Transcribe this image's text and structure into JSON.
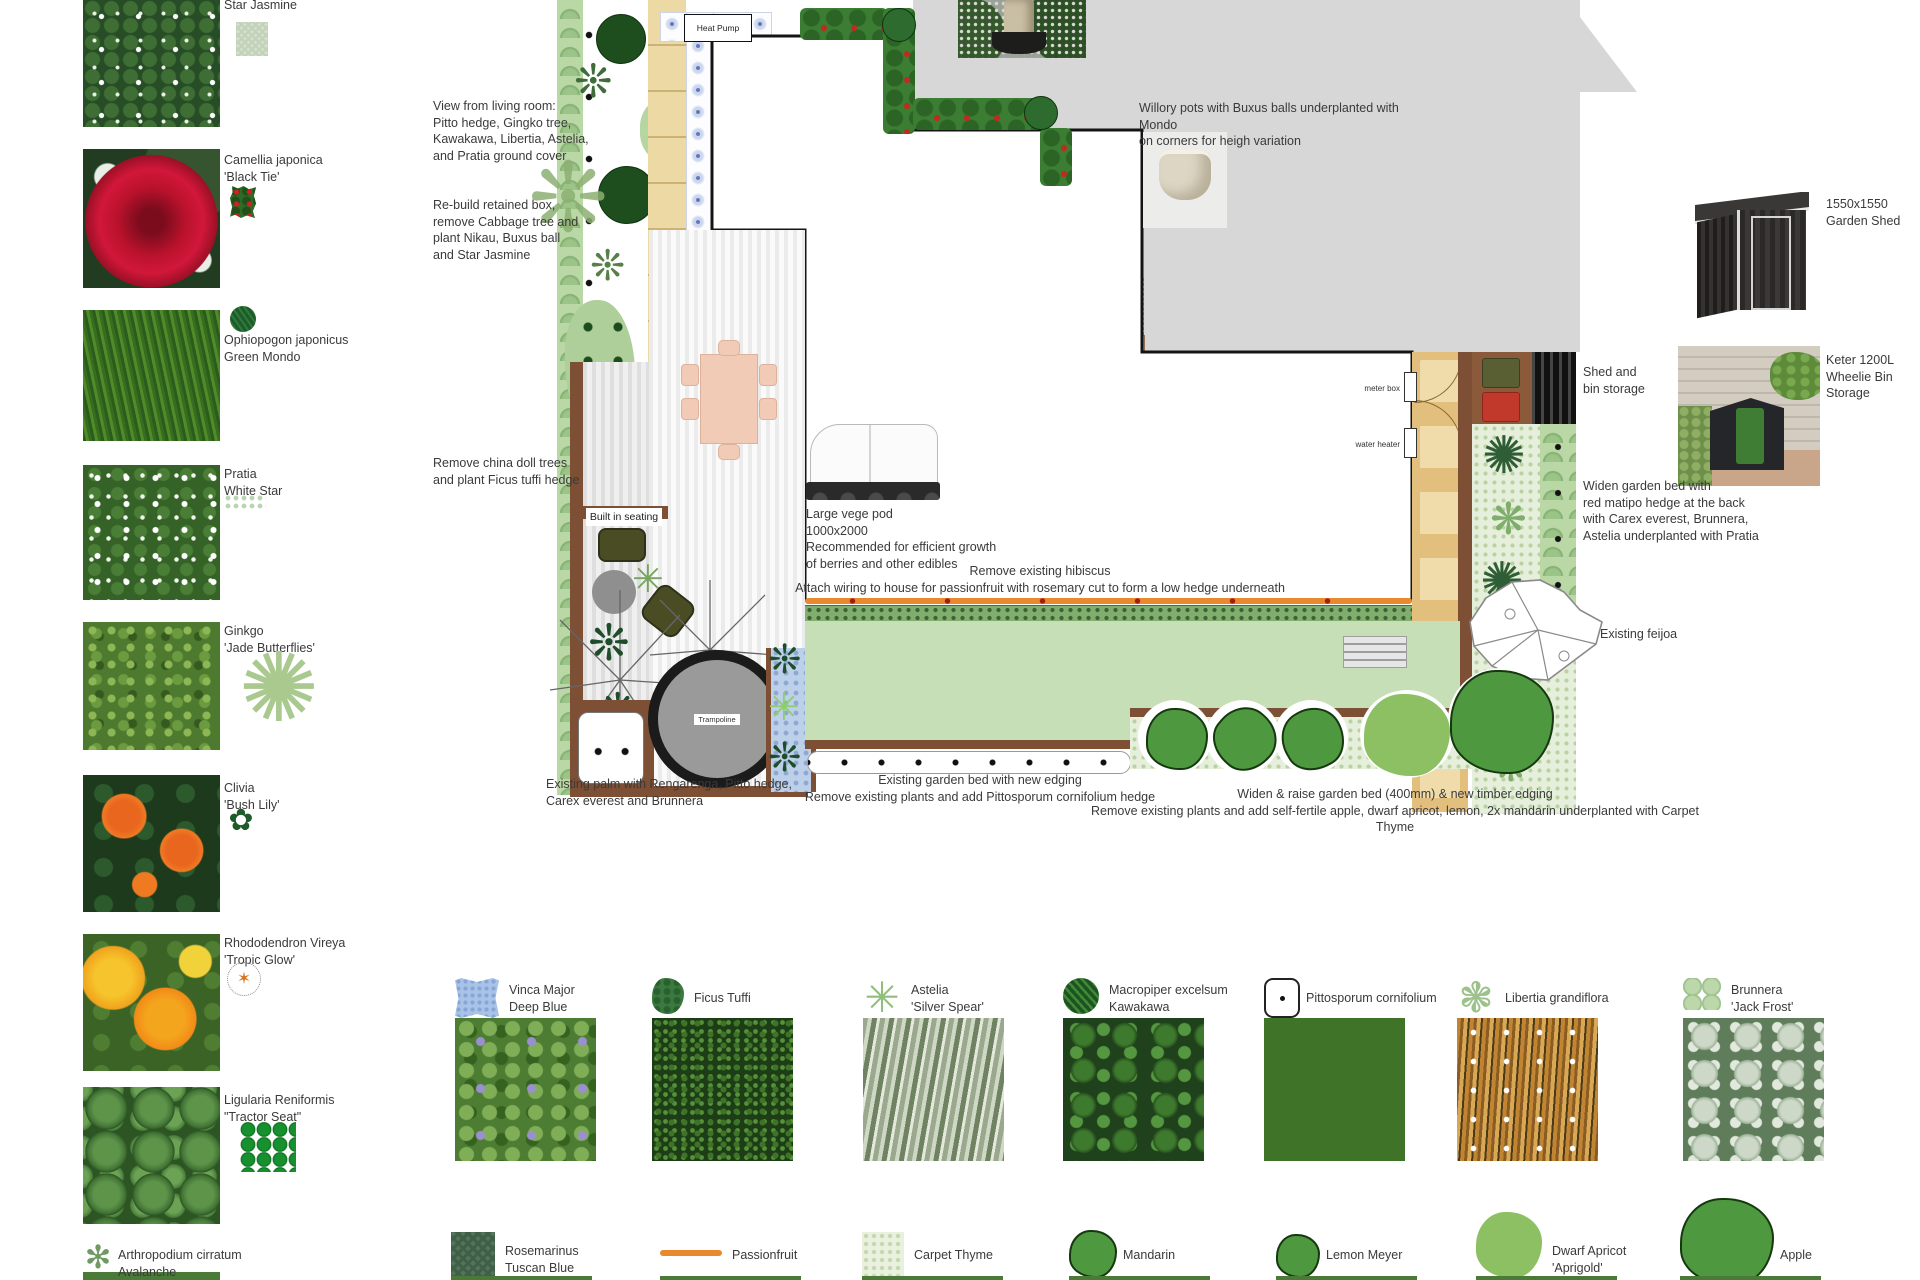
{
  "sidebar": {
    "items": [
      {
        "name": "Star Jasmine",
        "variety": "",
        "icon": "swatch-light"
      },
      {
        "name": "Camellia japonica",
        "variety": "'Black Tie'",
        "icon": "camellia"
      },
      {
        "name": "Ophiopogon japonicus",
        "variety": "Green Mondo",
        "icon": "mondo"
      },
      {
        "name": "Pratia",
        "variety": "White Star",
        "icon": "pratia-swatch"
      },
      {
        "name": "Ginkgo",
        "variety": "'Jade Butterflies'",
        "icon": "sunburst"
      },
      {
        "name": "Clivia",
        "variety": "'Bush Lily'",
        "icon": "clivia"
      },
      {
        "name": "Rhododendron Vireya",
        "variety": "'Tropic Glow'",
        "icon": "vireya"
      },
      {
        "name": "Ligularia Reniformis",
        "variety": "\"Tractor Seat\"",
        "icon": "ligularia"
      },
      {
        "name": "Arthropodium cirratum",
        "variety": "Avalanche",
        "icon": "avalanche"
      }
    ]
  },
  "plan": {
    "labels": {
      "heat_pump": "Heat Pump",
      "trampoline": "Trampoline",
      "bench_seat": "bench seat",
      "meter_box": "meter box",
      "water_heater": "water heater",
      "built_in_seating": "Built in seating"
    },
    "annotations": {
      "view_living_room": "View from living room:\nPitto hedge,  Gingko tree,\nKawakawa, Libertia, Astelia,\nand Pratia ground cover",
      "rebuild_retained": "Re-build retained box,\nremove Cabbage tree and\nplant Nikau, Buxus ball\nand Star Jasmine",
      "remove_china_doll": "Remove china doll trees\nand plant  Ficus tuffi hedge",
      "vege_pod": "Large vege pod\n1000x2000\nRecommended for efficient growth\nof berries and other edibles",
      "remove_hibiscus": "Remove existing hibiscus\nAttach wiring to house for passionfruit with rosemary cut to form a low hedge underneath",
      "existing_palm": "Existing palm with Rengarenga, Pitto hedge,\nCarex everest and Brunnera",
      "existing_bed": "Existing garden bed with new edging\nRemove existing plants and add Pittosporum cornifolium hedge",
      "widen_raise": "Widen & raise garden bed (400mm) & new timber edging\nRemove existing plants and add self-fertile apple, dwarf apricot, lemon, 2x mandarin underplanted with Carpet Thyme",
      "willory": "Willory pots with Buxus balls underplanted with Mondo\non corners for heigh variation",
      "shed_bin": "Shed and\nbin storage",
      "widen_bed_right": "Widen garden bed with\nred matipo hedge at the back\nwith Carex everest, Brunnera,\nAstelia underplanted with Pratia",
      "feijoa": "Existing feijoa",
      "shed_label": "1550x1550\nGarden Shed",
      "keter_label": "Keter 1200L\nWheelie Bin Storage"
    }
  },
  "legend": {
    "row1": [
      {
        "name": "Vinca Major",
        "variety": "Deep Blue",
        "icon": "vinca-swatch"
      },
      {
        "name": "Ficus Tuffi",
        "variety": "",
        "icon": "ficus"
      },
      {
        "name": "Astelia",
        "variety": "'Silver Spear'",
        "icon": "astelia"
      },
      {
        "name": "Macropiper excelsum",
        "variety": "Kawakawa",
        "icon": "kawakawa"
      },
      {
        "name": "Pittosporum cornifolium",
        "variety": "",
        "icon": "pitto-square"
      },
      {
        "name": "Libertia grandiflora",
        "variety": "",
        "icon": "libertia"
      },
      {
        "name": "Brunnera",
        "variety": "'Jack Frost'",
        "icon": "brunnera"
      }
    ],
    "row2": [
      {
        "name": "Rosemarinus",
        "variety": "Tuscan Blue",
        "icon": "rosemary-swatch"
      },
      {
        "name": "Passionfruit",
        "variety": "",
        "icon": "passionfruit-line"
      },
      {
        "name": "Carpet Thyme",
        "variety": "",
        "icon": "thyme-swatch"
      },
      {
        "name": "Mandarin",
        "variety": "",
        "icon": "tree-orange-small"
      },
      {
        "name": "Lemon Meyer",
        "variety": "",
        "icon": "tree-yellow-small"
      },
      {
        "name": "Dwarf Apricot",
        "variety": "'Aprigold'",
        "icon": "tree-apricot"
      },
      {
        "name": "Apple",
        "variety": "",
        "icon": "tree-apple"
      }
    ]
  }
}
